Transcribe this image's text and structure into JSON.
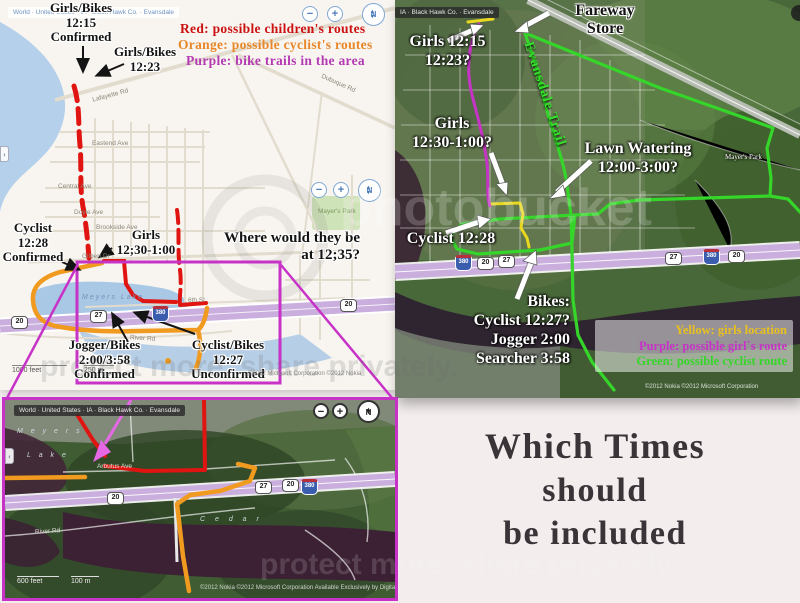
{
  "page": {
    "title": {
      "lines": [
        "Which Times",
        "should",
        "be included"
      ]
    },
    "watermark": {
      "brand": "photobucket",
      "tagline": "protect more. share privately."
    }
  },
  "shields": {
    "us20": "20",
    "ia27": "27",
    "i380": "380"
  },
  "left_map": {
    "breadcrumb": "World · United States · IA · Black Hawk Co. · Evansdale",
    "controls": {
      "zoom_out": "−",
      "zoom_in": "+",
      "compass": "N",
      "pan_left": "‹"
    },
    "legend": {
      "red": "Red:  possible children's routes",
      "orange": "Orange:  possible cyclist's routes",
      "purple": "Purple:  bike trails in the area"
    },
    "annotations": {
      "girls_bikes_1215": "Girls/Bikes\n12:15\nConfirmed",
      "girls_bikes_1223": "Girls/Bikes\n12:23",
      "cyclist_1228": "Cyclist\n12:28\nConfirmed",
      "girls_1230": "Girls\n12;30-1:00",
      "where": "Where would they be\nat 12;35?",
      "jogger": "Jogger/Bikes\n2:00/3:58\nConfirmed",
      "cyclist_bikes_1227": "Cyclist/Bikes\n12:27\nUnconfirmed"
    },
    "streets": {
      "lafayette": "Lafayette Rd",
      "dubuque": "Dubuque Rd",
      "central": "Central Ave",
      "eastend": "Eastend Ave",
      "brookside": "Brookside Ave",
      "doyle": "Doyle Ave",
      "gilbert": "Gilbert Dr",
      "meyers_lake": "Meyers Lake",
      "mayers_park": "Mayer's Park",
      "river_rd": "River Rd",
      "sixth": "6th St"
    },
    "scale": {
      "feet": "1000 feet",
      "meters": "250 m"
    },
    "copyright": "©2012 Microsoft Corporation   ©2012 Nokia"
  },
  "right_map": {
    "breadcrumb": "IA · Black Hawk Co. · Evansdale",
    "annotations": {
      "fareway": "Fareway\nStore",
      "girls_1215": "Girls 12:15\n12:23?",
      "girls_1230": "Girls\n12:30-1:00?",
      "lawn": "Lawn Watering\n12:00-3:00?",
      "trail": "Evansdale Trail",
      "cyclist_1228": "Cyclist 12:28",
      "bikes": "Bikes:\nCyclist 12:27?\nJogger 2:00\nSearcher 3:58",
      "mayers_park": "Mayer's Park"
    },
    "legend": {
      "yellow": "Yellow:  girls location",
      "purple": "Purple:  possible girl`s route",
      "green": "Green:  possible cyclist route"
    },
    "copyright": "©2012 Nokia   ©2012 Microsoft Corporation"
  },
  "bottom_map": {
    "breadcrumb": "World · United States · IA · Black Hawk Co. · Evansdale",
    "labels": {
      "meyers": "M e y e r s",
      "lake": "L a k e",
      "cedar": "C e d a r",
      "river_rd": "River Rd",
      "arbutus": "Arbutus Ave"
    },
    "controls": {
      "zoom_out": "−",
      "zoom_in": "+",
      "compass": "N",
      "pan_left": "‹"
    },
    "scale": {
      "feet": "600 feet",
      "meters": "100 m"
    },
    "copyright": "©2012 Nokia   ©2012 Microsoft Corporation   Available Exclusively by DigitalGlobe"
  },
  "colors": {
    "red_route": "#e01410",
    "orange_route": "#f09a20",
    "purple_route": "#c633c6",
    "green_route": "#35d52a",
    "yellow_route": "#e8d820",
    "highway": "#c9aede",
    "legend_red": "#cc1111",
    "legend_orange": "#e8872a",
    "legend_purple": "#b43ab4",
    "legend_yellow": "#e8c020",
    "title_text": "#3a3338"
  }
}
